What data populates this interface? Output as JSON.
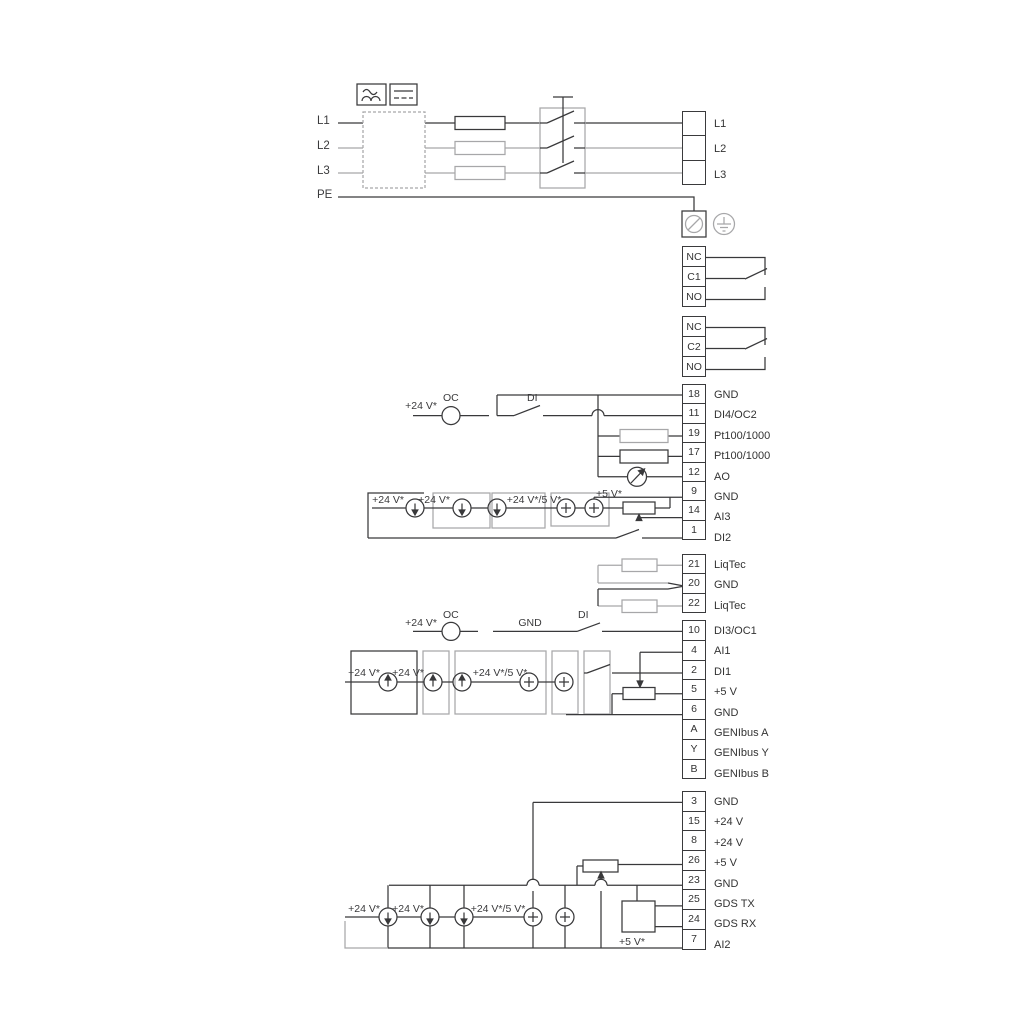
{
  "colors": {
    "dark": "#39393b",
    "gray": "#a7a7a9",
    "text": "#333333"
  },
  "mains": {
    "l1": "L1",
    "l2": "L2",
    "l3": "L3",
    "pe": "PE",
    "out_l1": "L1",
    "out_l2": "L2",
    "out_l3": "L3"
  },
  "relay1": {
    "nc": "NC",
    "c": "C1",
    "no": "NO"
  },
  "relay2": {
    "nc": "NC",
    "c": "C2",
    "no": "NO"
  },
  "io1": {
    "r0n": "18",
    "r0l": "GND",
    "r1n": "11",
    "r1l": "DI4/OC2",
    "r2n": "19",
    "r2l": "Pt100/1000",
    "r3n": "17",
    "r3l": "Pt100/1000",
    "r4n": "12",
    "r4l": "AO",
    "r5n": "9",
    "r5l": "GND",
    "r6n": "14",
    "r6l": "AI3",
    "r7n": "1",
    "r7l": "DI2"
  },
  "io2": {
    "r0n": "21",
    "r0l": "LiqTec",
    "r1n": "20",
    "r1l": "GND",
    "r2n": "22",
    "r2l": "LiqTec"
  },
  "io3": {
    "r0n": "10",
    "r0l": "DI3/OC1",
    "r1n": "4",
    "r1l": "AI1",
    "r2n": "2",
    "r2l": "DI1",
    "r3n": "5",
    "r3l": "+5 V",
    "r4n": "6",
    "r4l": "GND",
    "r5n": "A",
    "r5l": "GENIbus A",
    "r6n": "Y",
    "r6l": "GENIbus Y",
    "r7n": "B",
    "r7l": "GENIbus B"
  },
  "io4": {
    "r0n": "3",
    "r0l": "GND",
    "r1n": "15",
    "r1l": "+24 V",
    "r2n": "8",
    "r2l": "+24 V",
    "r3n": "26",
    "r3l": "+5 V",
    "r4n": "23",
    "r4l": "GND",
    "r5n": "25",
    "r5l": "GDS TX",
    "r6n": "24",
    "r6l": "GDS RX",
    "r7n": "7",
    "r7l": "AI2"
  },
  "sec_di4": {
    "v24": "+24 V*",
    "oc": "OC",
    "di": "DI"
  },
  "sec_ai3": {
    "v24a": "+24 V*",
    "v24b": "+24 V*",
    "v245": "+24 V*/5 V*",
    "v5": "+5 V*"
  },
  "sec_di3": {
    "v24": "+24 V*",
    "oc": "OC",
    "gnd": "GND",
    "di": "DI"
  },
  "sec_ai1": {
    "v24a": "+24 V*",
    "v24b": "+24 V*",
    "v245": "+24 V*/5 V*"
  },
  "sec_ai2": {
    "v24a": "+24 V*",
    "v24b": "+24 V*",
    "v245": "+24 V*/5 V*",
    "v5": "+5 V*"
  }
}
